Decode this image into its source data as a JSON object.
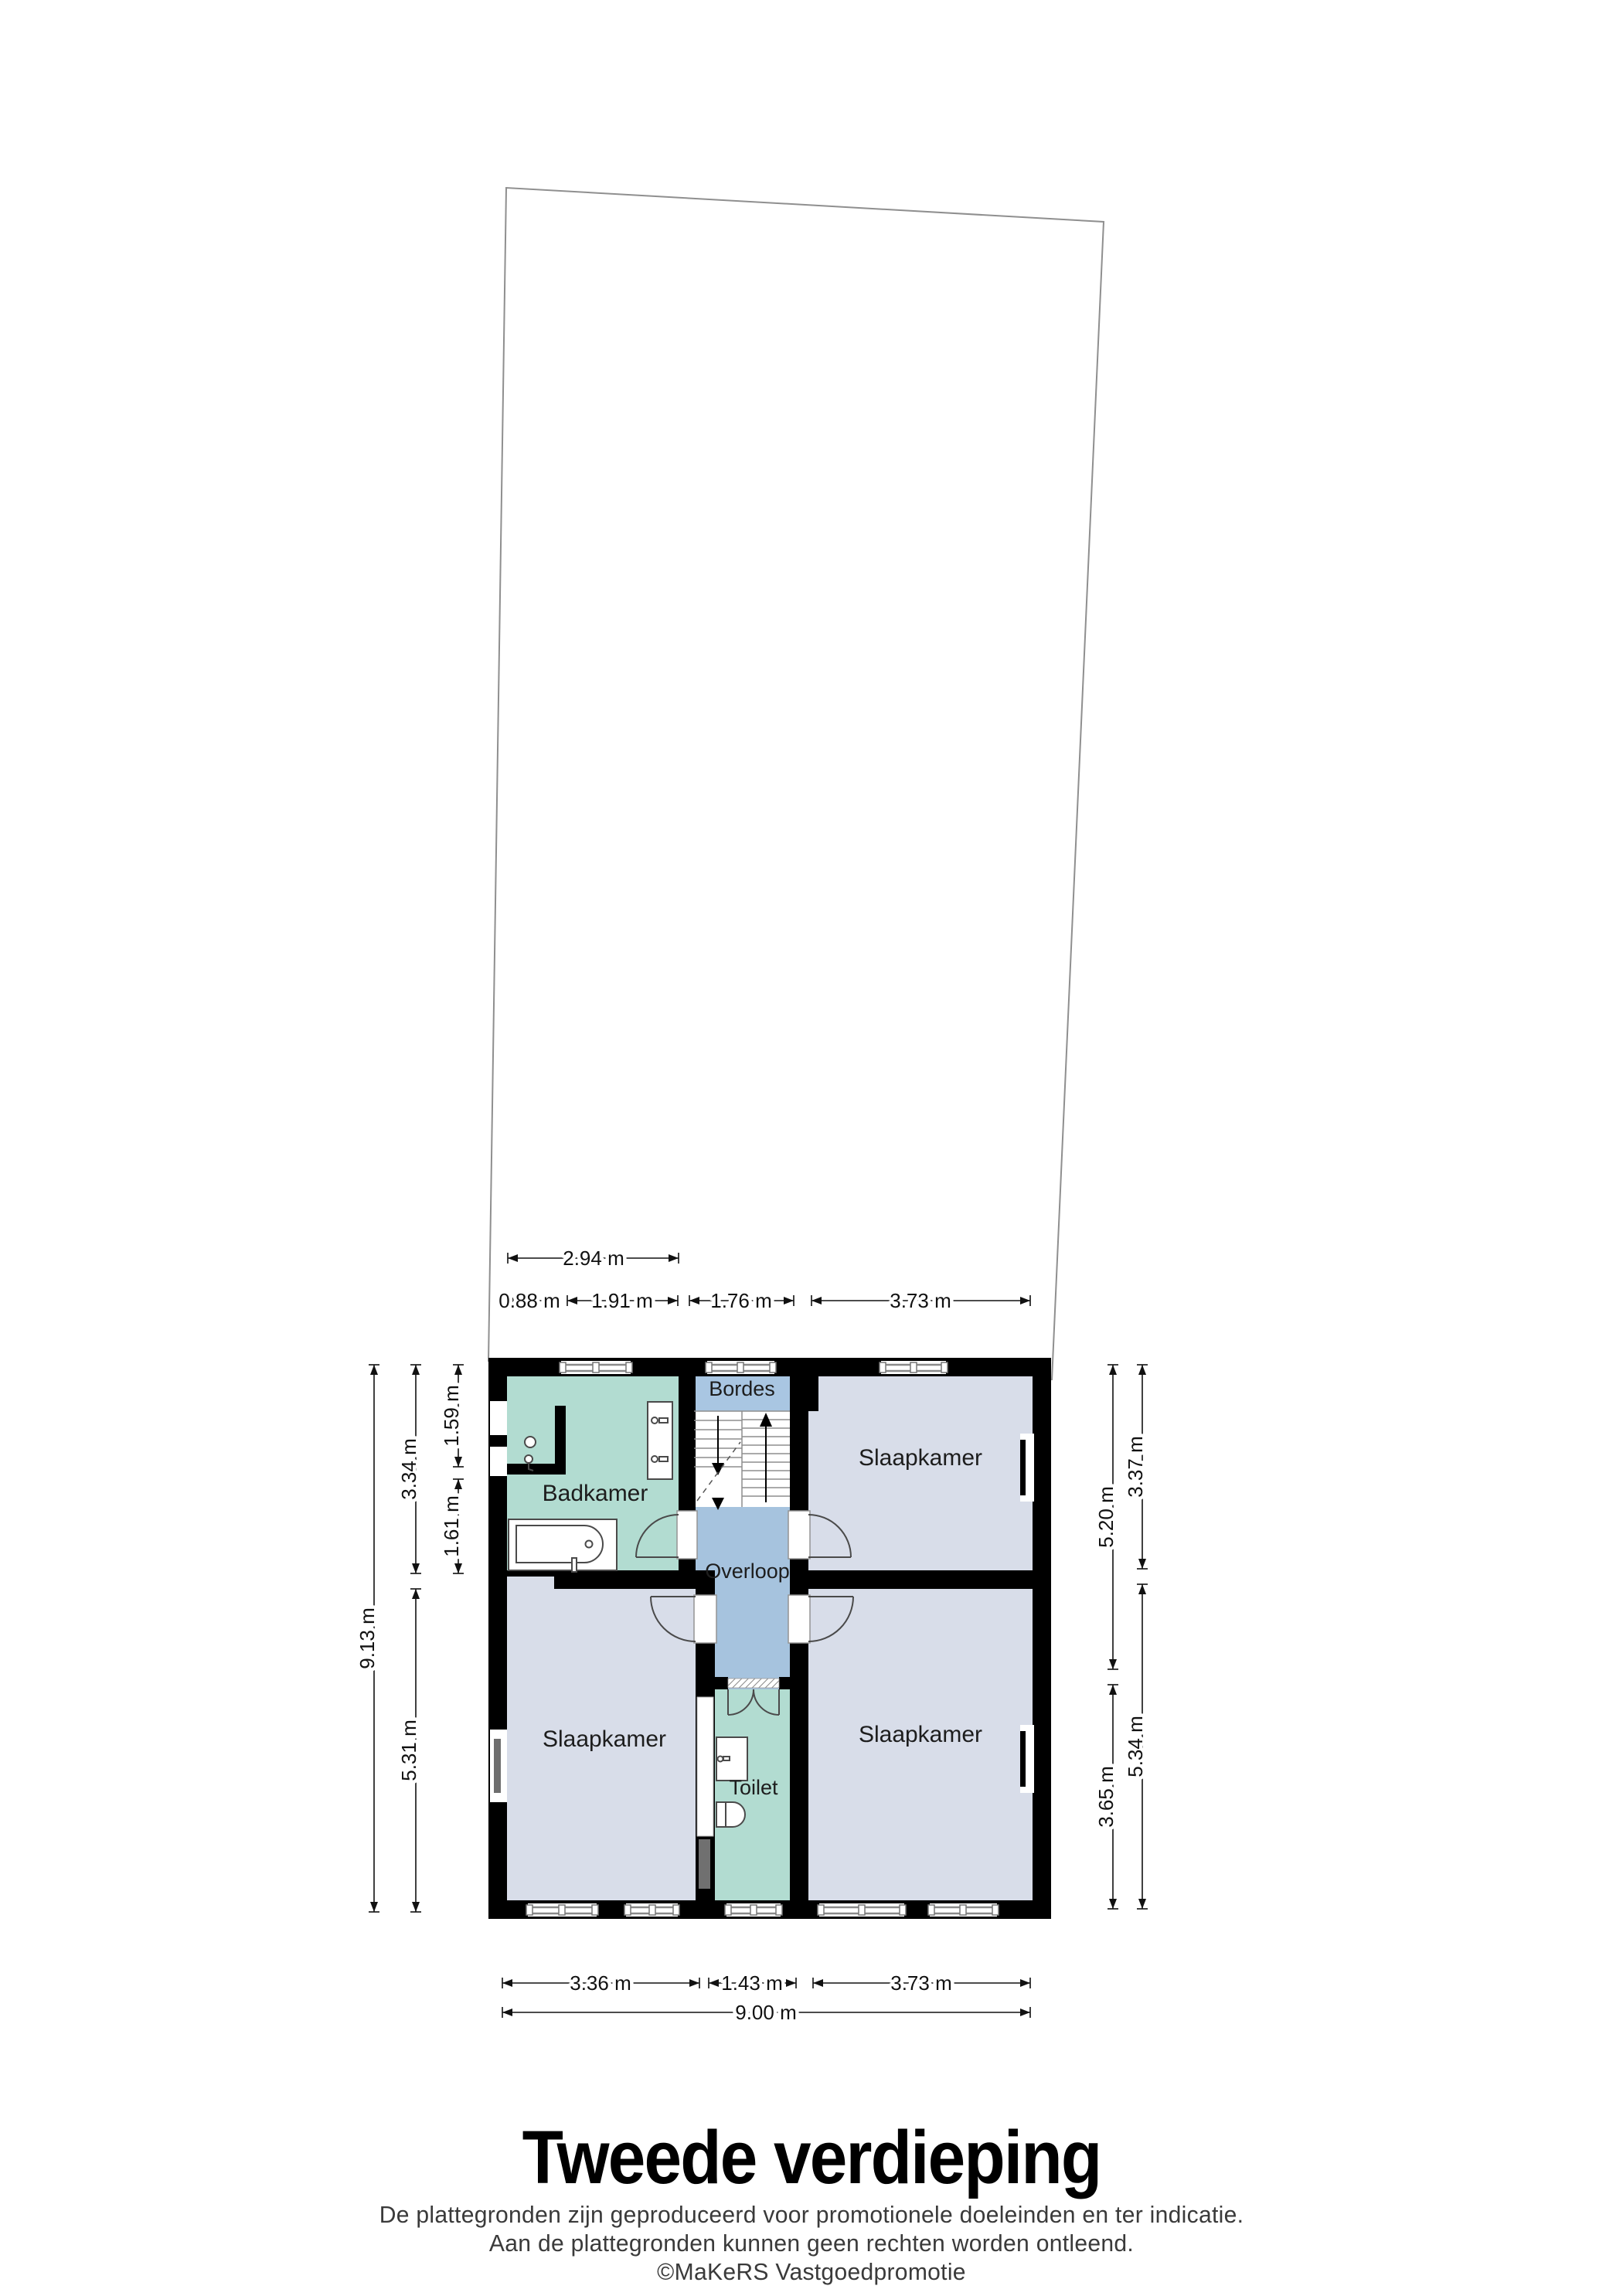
{
  "header": {
    "title": "Tweede verdieping"
  },
  "footer": {
    "line1": "De plattegronden zijn geproduceerd voor promotionele doeleinden en ter indicatie.",
    "line2": "Aan de plattegronden kunnen geen rechten worden ontleend.",
    "line3": "©MaKeRS Vastgoedpromotie"
  },
  "rooms": {
    "badkamer": "Badkamer",
    "bordes": "Bordes",
    "overloop": "Overloop",
    "toilet": "Toilet",
    "slaapkamer_rechtsboven": "Slaapkamer",
    "slaapkamer_linksonder": "Slaapkamer",
    "slaapkamer_rechtsonder": "Slaapkamer"
  },
  "dimensions": {
    "top": {
      "badkamer_breedte": "2.94 m",
      "seg_a": "0.88 m",
      "seg_b": "1.91 m",
      "trap_breedte": "1.76 m",
      "slaapkamer_breedte": "3.73 m"
    },
    "bottom": {
      "slaapkamer_links": "3.36 m",
      "toilet_breedte": "1.43 m",
      "slaapkamer_rechts": "3.73 m",
      "totaal": "9.00 m"
    },
    "left": {
      "totaal": "9.13 m",
      "boven": "3.34 m",
      "onder": "5.31 m",
      "badkamer_boven": "1.59 m",
      "badkamer_onder": "1.61 m"
    },
    "right": {
      "binnen_boven": "5.20 m",
      "binnen_onder": "3.65 m",
      "buiten_boven": "3.37 m",
      "buiten_onder": "5.34 m"
    }
  },
  "colors": {
    "wall": "#000000",
    "bedroom_fill": "#d8dde9",
    "bathroom_fill": "#b2dcd1",
    "hallway_fill": "#a6c3de",
    "landing_fill": "#a9c6e2",
    "stairs_fill": "#ffffff",
    "parcel_outline": "#8f8f8f"
  }
}
